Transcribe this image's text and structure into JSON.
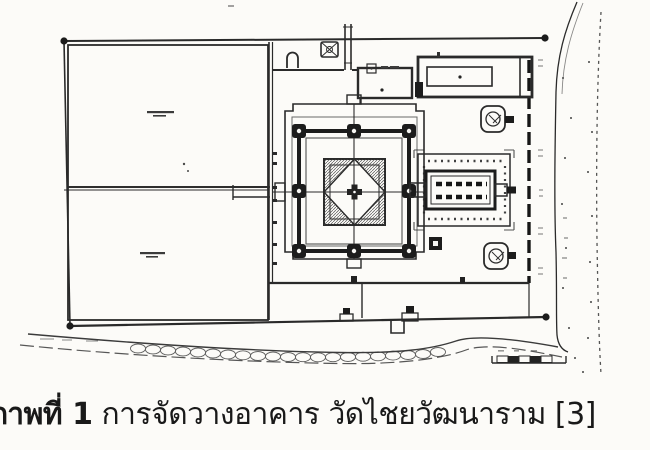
{
  "figure": {
    "caption": {
      "label": "ภาพที่ 1",
      "text": "การจัดวางอาคาร วัดไชยวัฒนาราม [3]"
    }
  },
  "colors": {
    "page_background": "#fcfbf8",
    "drawing_ink": "#2b2b2b",
    "wall_dark": "#1b1b1b",
    "caption_text": "#191919"
  }
}
